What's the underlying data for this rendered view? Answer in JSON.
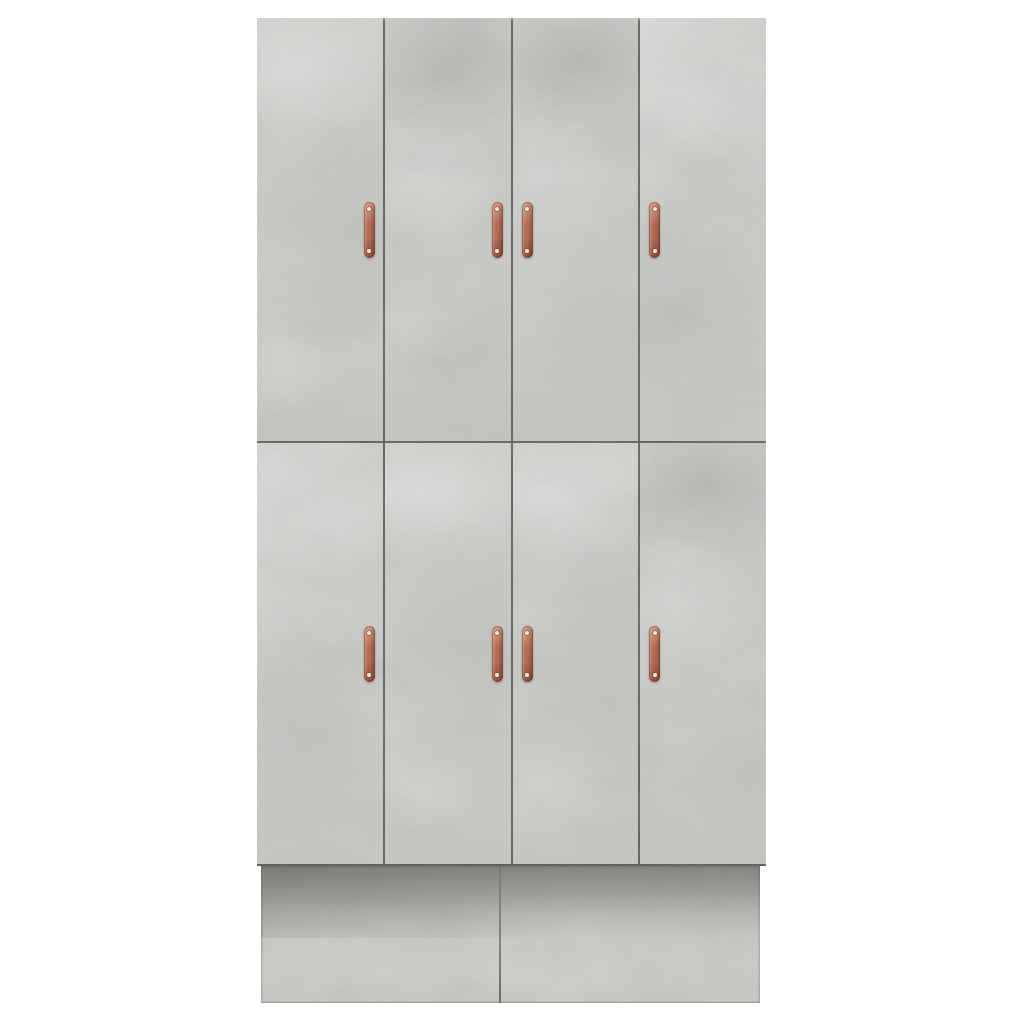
{
  "image": {
    "type": "product-photo",
    "subject": "tall wardrobe cabinet with eight doors and base plinth",
    "finish": "concrete grey",
    "background_color": "#ffffff"
  },
  "product": {
    "colors": {
      "background": "#ffffff",
      "body": "#cbccc8",
      "body-light": "#d6d7d3",
      "body-dark": "#bfc0bc",
      "seam": "#5c5b57",
      "handle": "#b06a50",
      "handle-light": "#d49a7e",
      "handle-dark": "#8e4b36",
      "screw": "#f4ebe4"
    },
    "structure": {
      "door_rows": 2,
      "doors_per_row": 4,
      "handles_per_door": 1,
      "handle_style": "vertical copper pull with two screws",
      "base": "recessed plinth with center seam and overhang shadow"
    },
    "doors": {
      "rows": [
        {
          "name": "top",
          "doors": [
            {
              "handle_side": "right"
            },
            {
              "handle_side": "right"
            },
            {
              "handle_side": "left"
            },
            {
              "handle_side": "left"
            }
          ]
        },
        {
          "name": "bottom",
          "doors": [
            {
              "handle_side": "right"
            },
            {
              "handle_side": "right"
            },
            {
              "handle_side": "left"
            },
            {
              "handle_side": "left"
            }
          ]
        }
      ]
    }
  }
}
